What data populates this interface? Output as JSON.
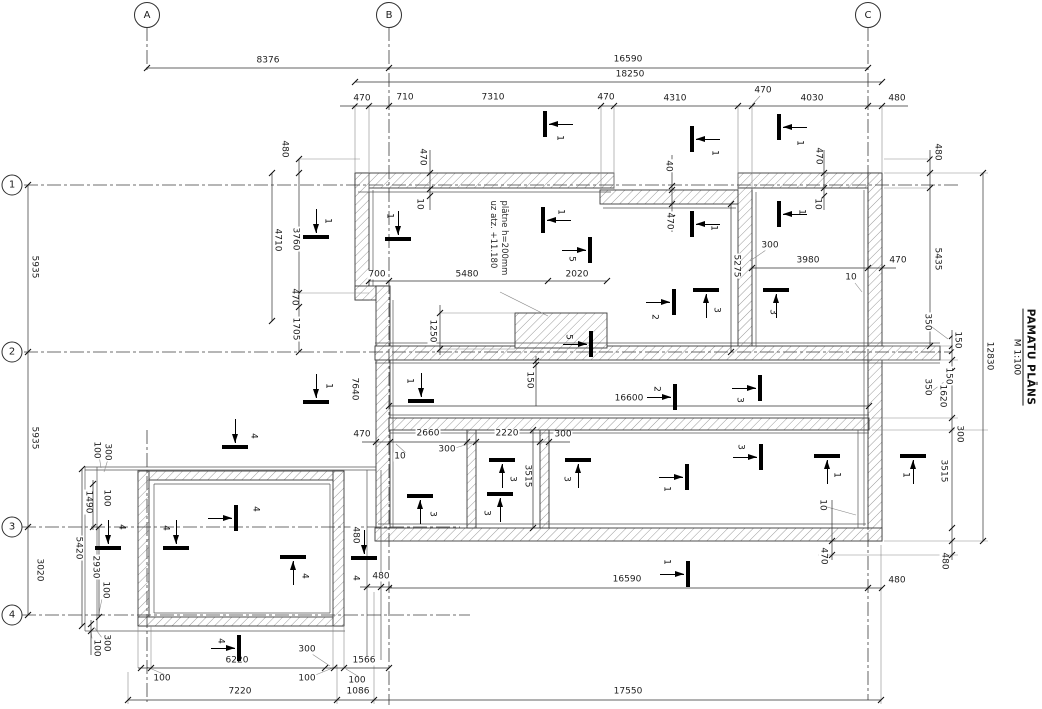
{
  "title": {
    "name": "PAMATU PLĀNS",
    "scale": "M 1:100"
  },
  "note": {
    "line1": "plātne h=200mm",
    "line2": "uz atz. +11.180"
  },
  "grid": {
    "cols": [
      {
        "label": "A",
        "x": 147,
        "y": 15
      },
      {
        "label": "B",
        "x": 389,
        "y": 15
      },
      {
        "label": "C",
        "x": 868,
        "y": 15
      }
    ],
    "rows": [
      {
        "label": "1",
        "x": 12,
        "y": 185
      },
      {
        "label": "2",
        "x": 12,
        "y": 352
      },
      {
        "label": "3",
        "x": 12,
        "y": 527
      },
      {
        "label": "4",
        "x": 12,
        "y": 615
      }
    ]
  },
  "dimensions": [
    {
      "t": "8376",
      "x": 268,
      "y": 61,
      "r": 0
    },
    {
      "t": "16590",
      "x": 628,
      "y": 60,
      "r": 0
    },
    {
      "t": "18250",
      "x": 630,
      "y": 75,
      "r": 0
    },
    {
      "t": "470",
      "x": 362,
      "y": 99,
      "r": 0
    },
    {
      "t": "710",
      "x": 405,
      "y": 98,
      "r": 0
    },
    {
      "t": "7310",
      "x": 493,
      "y": 98,
      "r": 0
    },
    {
      "t": "470",
      "x": 606,
      "y": 98,
      "r": 0
    },
    {
      "t": "4310",
      "x": 675,
      "y": 99,
      "r": 0
    },
    {
      "t": "470",
      "x": 763,
      "y": 91,
      "r": 0
    },
    {
      "t": "4030",
      "x": 812,
      "y": 99,
      "r": 0
    },
    {
      "t": "480",
      "x": 897,
      "y": 99,
      "r": 0
    },
    {
      "t": "480",
      "x": 284,
      "y": 149,
      "r": 90
    },
    {
      "t": "5935",
      "x": 34,
      "y": 267,
      "r": 90
    },
    {
      "t": "5935",
      "x": 34,
      "y": 438,
      "r": 90
    },
    {
      "t": "3020",
      "x": 39,
      "y": 570,
      "r": 90
    },
    {
      "t": "4710",
      "x": 277,
      "y": 240,
      "r": 90
    },
    {
      "t": "3760",
      "x": 295,
      "y": 239,
      "r": 90
    },
    {
      "t": "470",
      "x": 294,
      "y": 297,
      "r": 90
    },
    {
      "t": "1705",
      "x": 295,
      "y": 329,
      "r": 90
    },
    {
      "t": "470",
      "x": 422,
      "y": 157,
      "r": 90
    },
    {
      "t": "10",
      "x": 419,
      "y": 204,
      "r": 90
    },
    {
      "t": "40",
      "x": 668,
      "y": 166,
      "r": 90
    },
    {
      "t": "470",
      "x": 669,
      "y": 221,
      "r": 90
    },
    {
      "t": "470",
      "x": 818,
      "y": 156,
      "r": 90
    },
    {
      "t": "10",
      "x": 817,
      "y": 204,
      "r": 90
    },
    {
      "t": "700",
      "x": 377,
      "y": 275,
      "r": 0
    },
    {
      "t": "5480",
      "x": 467,
      "y": 275,
      "r": 0
    },
    {
      "t": "2020",
      "x": 577,
      "y": 275,
      "r": 0
    },
    {
      "t": "300",
      "x": 770,
      "y": 246,
      "r": 0
    },
    {
      "t": "3980",
      "x": 808,
      "y": 261,
      "r": 0
    },
    {
      "t": "470",
      "x": 898,
      "y": 261,
      "r": 0
    },
    {
      "t": "10",
      "x": 851,
      "y": 278,
      "r": 0
    },
    {
      "t": "5275",
      "x": 736,
      "y": 266,
      "r": 90
    },
    {
      "t": "1250",
      "x": 432,
      "y": 331,
      "r": 90
    },
    {
      "t": "150",
      "x": 529,
      "y": 380,
      "r": 90
    },
    {
      "t": "16600",
      "x": 629,
      "y": 399,
      "r": 0
    },
    {
      "t": "470",
      "x": 362,
      "y": 435,
      "r": 0
    },
    {
      "t": "2660",
      "x": 428,
      "y": 434,
      "r": 0
    },
    {
      "t": "10",
      "x": 400,
      "y": 457,
      "r": 0
    },
    {
      "t": "300",
      "x": 447,
      "y": 450,
      "r": 0
    },
    {
      "t": "2220",
      "x": 507,
      "y": 434,
      "r": 0
    },
    {
      "t": "300",
      "x": 563,
      "y": 435,
      "r": 0
    },
    {
      "t": "3515",
      "x": 527,
      "y": 476,
      "r": 90
    },
    {
      "t": "7640",
      "x": 354,
      "y": 389,
      "r": 90
    },
    {
      "t": "480",
      "x": 937,
      "y": 152,
      "r": 90
    },
    {
      "t": "5435",
      "x": 937,
      "y": 259,
      "r": 90
    },
    {
      "t": "350",
      "x": 927,
      "y": 322,
      "r": 90
    },
    {
      "t": "150",
      "x": 957,
      "y": 340,
      "r": 90
    },
    {
      "t": "150",
      "x": 948,
      "y": 376,
      "r": 90
    },
    {
      "t": "350",
      "x": 927,
      "y": 387,
      "r": 90
    },
    {
      "t": "1620",
      "x": 942,
      "y": 396,
      "r": 90
    },
    {
      "t": "300",
      "x": 959,
      "y": 434,
      "r": 90
    },
    {
      "t": "3515",
      "x": 943,
      "y": 471,
      "r": 90
    },
    {
      "t": "12830",
      "x": 989,
      "y": 356,
      "r": 90
    },
    {
      "t": "10",
      "x": 822,
      "y": 505,
      "r": 90
    },
    {
      "t": "470",
      "x": 823,
      "y": 556,
      "r": 90
    },
    {
      "t": "480",
      "x": 944,
      "y": 561,
      "r": 90
    },
    {
      "t": "16590",
      "x": 627,
      "y": 580,
      "r": 0
    },
    {
      "t": "480",
      "x": 897,
      "y": 581,
      "r": 0
    },
    {
      "t": "480",
      "x": 355,
      "y": 535,
      "r": 90
    },
    {
      "t": "480",
      "x": 381,
      "y": 577,
      "r": 0
    },
    {
      "t": "17550",
      "x": 628,
      "y": 692,
      "r": 0
    },
    {
      "t": "7220",
      "x": 240,
      "y": 692,
      "r": 0
    },
    {
      "t": "1086",
      "x": 358,
      "y": 692,
      "r": 0
    },
    {
      "t": "6220",
      "x": 237,
      "y": 661,
      "r": 0
    },
    {
      "t": "1566",
      "x": 364,
      "y": 661,
      "r": 0
    },
    {
      "t": "300",
      "x": 307,
      "y": 650,
      "r": 0
    },
    {
      "t": "100",
      "x": 162,
      "y": 679,
      "r": 0
    },
    {
      "t": "100",
      "x": 307,
      "y": 679,
      "r": 0
    },
    {
      "t": "100",
      "x": 357,
      "y": 681,
      "r": 0
    },
    {
      "t": "100",
      "x": 96,
      "y": 450,
      "r": 90
    },
    {
      "t": "300",
      "x": 107,
      "y": 452,
      "r": 90
    },
    {
      "t": "1490",
      "x": 88,
      "y": 502,
      "r": 90
    },
    {
      "t": "100",
      "x": 106,
      "y": 498,
      "r": 90
    },
    {
      "t": "5420",
      "x": 78,
      "y": 548,
      "r": 90
    },
    {
      "t": "2930",
      "x": 95,
      "y": 567,
      "r": 90
    },
    {
      "t": "100",
      "x": 105,
      "y": 590,
      "r": 90
    },
    {
      "t": "300",
      "x": 106,
      "y": 643,
      "r": 90
    },
    {
      "t": "100",
      "x": 96,
      "y": 648,
      "r": 90
    }
  ],
  "markers": [
    {
      "t": "1",
      "d": "left",
      "x": 545,
      "y": 124,
      "lx": 559,
      "ly": 138
    },
    {
      "t": "1",
      "d": "left",
      "x": 692,
      "y": 139,
      "lx": 714,
      "ly": 153
    },
    {
      "t": "1",
      "d": "left",
      "x": 779,
      "y": 127,
      "lx": 799,
      "ly": 143
    },
    {
      "t": "1",
      "d": "left",
      "x": 692,
      "y": 224,
      "lx": 713,
      "ly": 228
    },
    {
      "t": "1",
      "d": "left",
      "x": 779,
      "y": 214,
      "lx": 801,
      "ly": 212
    },
    {
      "t": "1",
      "d": "down",
      "x": 316,
      "y": 237,
      "lx": 327,
      "ly": 221
    },
    {
      "t": "1",
      "d": "down",
      "x": 398,
      "y": 239,
      "lx": 389,
      "ly": 216
    },
    {
      "t": "1",
      "d": "left",
      "x": 543,
      "y": 220,
      "lx": 560,
      "ly": 212
    },
    {
      "t": "5",
      "d": "right",
      "x": 590,
      "y": 250,
      "lx": 571,
      "ly": 259
    },
    {
      "t": "5",
      "d": "right",
      "x": 591,
      "y": 344,
      "lx": 568,
      "ly": 337
    },
    {
      "t": "2",
      "d": "right",
      "x": 674,
      "y": 302,
      "lx": 654,
      "ly": 317
    },
    {
      "t": "3",
      "d": "up",
      "x": 706,
      "y": 290,
      "lx": 716,
      "ly": 310
    },
    {
      "t": "3",
      "d": "up",
      "x": 776,
      "y": 290,
      "lx": 772,
      "ly": 312
    },
    {
      "t": "2",
      "d": "right",
      "x": 675,
      "y": 397,
      "lx": 656,
      "ly": 389
    },
    {
      "t": "3",
      "d": "right",
      "x": 760,
      "y": 388,
      "lx": 739,
      "ly": 400
    },
    {
      "t": "3",
      "d": "up",
      "x": 420,
      "y": 496,
      "lx": 432,
      "ly": 514
    },
    {
      "t": "3",
      "d": "up",
      "x": 502,
      "y": 460,
      "lx": 512,
      "ly": 479
    },
    {
      "t": "3",
      "d": "up",
      "x": 500,
      "y": 494,
      "lx": 486,
      "ly": 513
    },
    {
      "t": "3",
      "d": "up",
      "x": 578,
      "y": 460,
      "lx": 566,
      "ly": 479
    },
    {
      "t": "1",
      "d": "right",
      "x": 687,
      "y": 477,
      "lx": 666,
      "ly": 489
    },
    {
      "t": "3",
      "d": "right",
      "x": 761,
      "y": 457,
      "lx": 740,
      "ly": 447
    },
    {
      "t": "1",
      "d": "up",
      "x": 827,
      "y": 456,
      "lx": 836,
      "ly": 475
    },
    {
      "t": "1",
      "d": "up",
      "x": 913,
      "y": 456,
      "lx": 905,
      "ly": 475
    },
    {
      "t": "1",
      "d": "right",
      "x": 688,
      "y": 574,
      "lx": 666,
      "ly": 562
    },
    {
      "t": "4",
      "d": "down",
      "x": 235,
      "y": 447,
      "lx": 253,
      "ly": 436
    },
    {
      "t": "4",
      "d": "down",
      "x": 108,
      "y": 548,
      "lx": 121,
      "ly": 527
    },
    {
      "t": "4",
      "d": "down",
      "x": 176,
      "y": 548,
      "lx": 165,
      "ly": 528
    },
    {
      "t": "4",
      "d": "right",
      "x": 236,
      "y": 518,
      "lx": 255,
      "ly": 509
    },
    {
      "t": "4",
      "d": "up",
      "x": 293,
      "y": 557,
      "lx": 304,
      "ly": 576
    },
    {
      "t": "4",
      "d": "down",
      "x": 364,
      "y": 558,
      "lx": 355,
      "ly": 578
    },
    {
      "t": "4",
      "d": "right",
      "x": 239,
      "y": 648,
      "lx": 220,
      "ly": 641
    },
    {
      "t": "1",
      "d": "down",
      "x": 316,
      "y": 402,
      "lx": 328,
      "ly": 386
    },
    {
      "t": "1",
      "d": "down",
      "x": 421,
      "y": 401,
      "lx": 409,
      "ly": 381
    }
  ]
}
